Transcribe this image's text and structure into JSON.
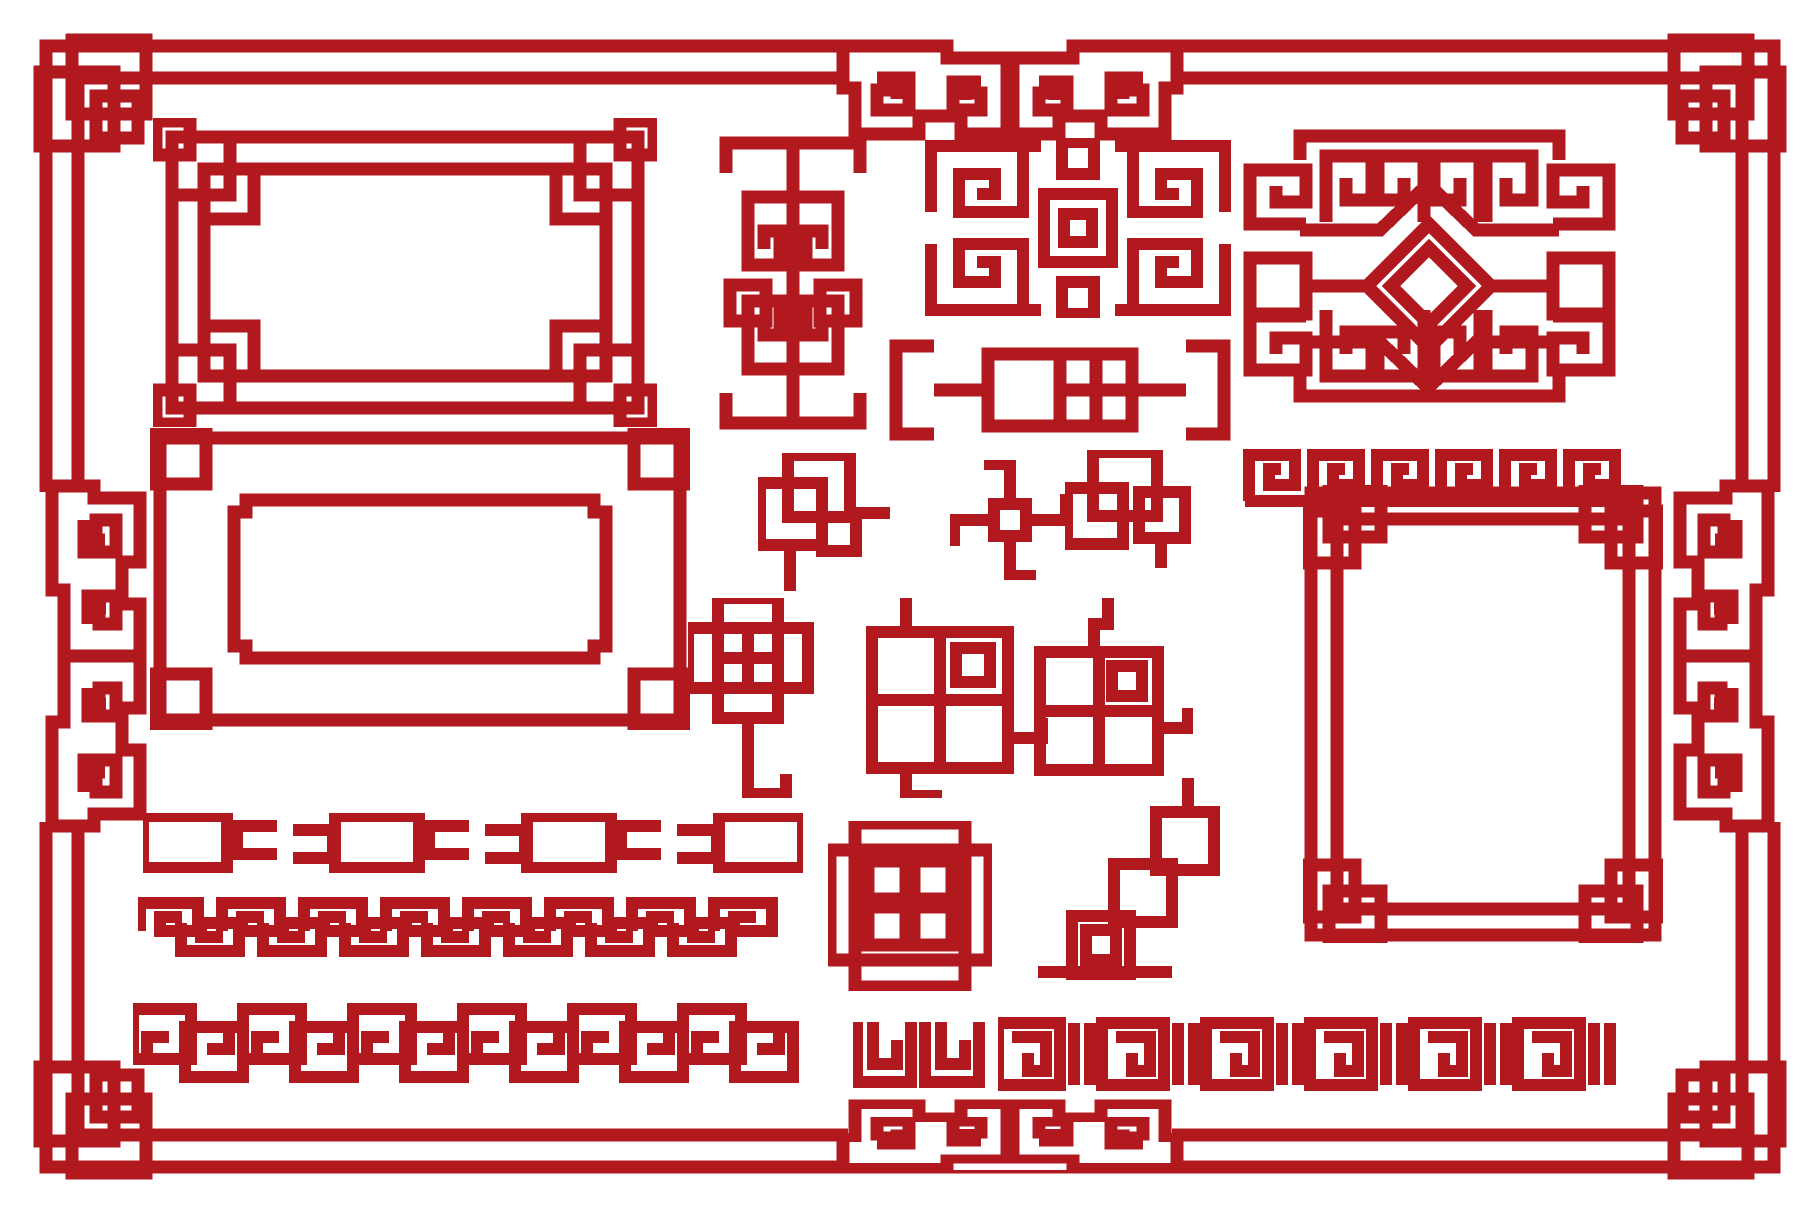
{
  "image": {
    "kind": "decorative-ornament-set",
    "subject": "Chinese ornamental red knot frames, corner elements and meander borders on white"
  },
  "colors": {
    "ornament": "#b1191f",
    "background": "#ffffff"
  },
  "ornaments": [
    {
      "id": "page-border",
      "label": "outer double-line border with corner knots and cloud scrolls"
    },
    {
      "id": "frame-knot-corners",
      "label": "rectangular frame with interlaced square knot corners"
    },
    {
      "id": "frame-stepped",
      "label": "rectangular frame with stepped inner corners and corner squares"
    },
    {
      "id": "vertical-scroll-panel",
      "label": "vertical panel with mirrored scrolls and side squares"
    },
    {
      "id": "lattice-block",
      "label": "square lattice block with four spirals around center square"
    },
    {
      "id": "bracket-divider",
      "label": "horizontal bracket divider with twin boxes"
    },
    {
      "id": "diamond-banner",
      "label": "wide banner with central double diamond, rods and scroll pairs"
    },
    {
      "id": "c-scroll-border",
      "label": "repeating C-scroll border"
    },
    {
      "id": "large-square-frame",
      "label": "large square double-line frame with knot corners"
    },
    {
      "id": "small-knot-1",
      "label": "small overlapping-squares knot with tails"
    },
    {
      "id": "small-knot-2",
      "label": "pinwheel scroll knot"
    },
    {
      "id": "small-knot-3",
      "label": "interlocked squares knot"
    },
    {
      "id": "corner-element-1",
      "label": "checkerboard corner knot with stem"
    },
    {
      "id": "corner-element-2",
      "label": "grid corner knot with hook and foot"
    },
    {
      "id": "corner-element-3",
      "label": "grid corner knot with jogged stem"
    },
    {
      "id": "chain-border",
      "label": "chain border of linked rectangles and clasps"
    },
    {
      "id": "meander-border",
      "label": "interlocking greek-key meander border"
    },
    {
      "id": "cross-medallion",
      "label": "cross medallion of two overlapped squares with four inner squares"
    },
    {
      "id": "staircase-corner",
      "label": "diagonal staircase of squares corner ornament"
    },
    {
      "id": "linked-squares-border",
      "label": "alternating up-down linked squares border"
    },
    {
      "id": "double-scroll-divider",
      "label": "two-unit scroll divider"
    },
    {
      "id": "spiral-bar-border",
      "label": "border of square spirals separated by twin bars"
    }
  ]
}
